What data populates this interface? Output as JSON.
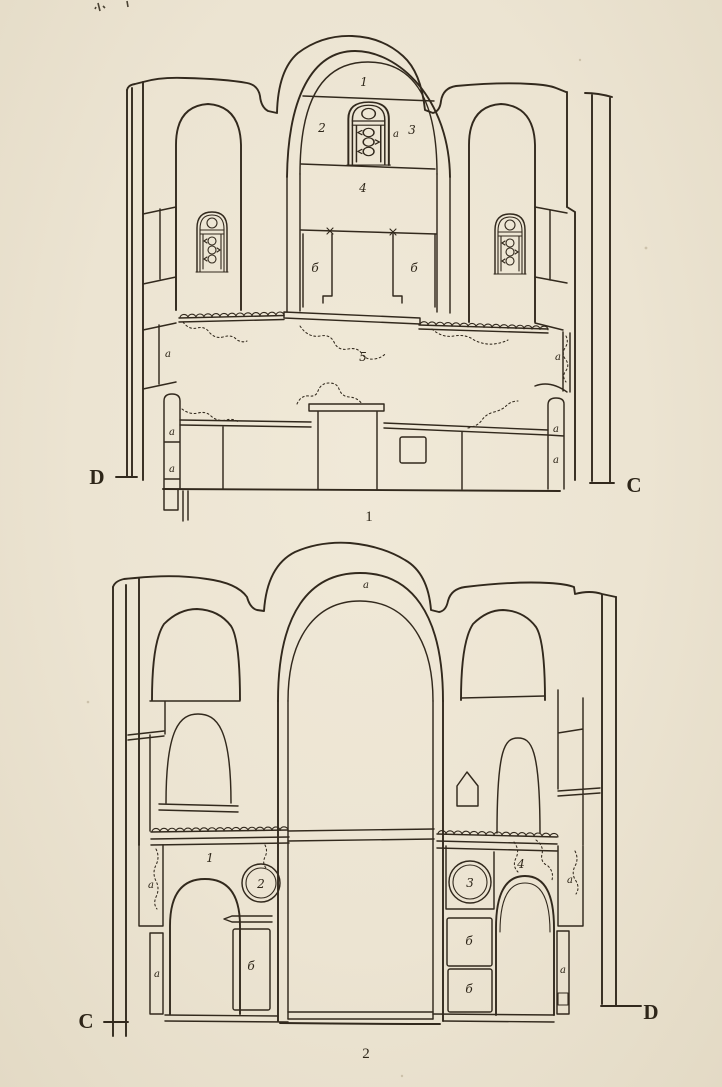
{
  "colors": {
    "paper": "#ece4d2",
    "ink": "#32291d"
  },
  "figure1": {
    "caption": "1",
    "left_letter": "D",
    "right_letter": "C",
    "labels": {
      "lunette": "1",
      "panel_left": "2",
      "panel_right": "3",
      "window_a": "a",
      "panel_below": "4",
      "door_flank_left": "б",
      "door_flank_right": "б",
      "hall": "5",
      "wall_left_a": "a",
      "pilaster_left_a_upper": "a",
      "pilaster_left_a_lower": "a",
      "wall_right_a": "a",
      "pilaster_right_a_upper": "a",
      "pilaster_right_a_lower": "a"
    }
  },
  "figure2": {
    "caption": "2",
    "left_letter": "C",
    "right_letter": "D",
    "labels": {
      "vault_a": "a",
      "gallery_left": "1",
      "medallion_left": "2",
      "medallion_right": "3",
      "gallery_right": "4",
      "door_left": "б",
      "door_right_upper": "б",
      "door_right_lower": "б",
      "pier_left_a": "a",
      "strip_left_a": "a",
      "pier_right_a": "a",
      "strip_right_a": "a"
    }
  }
}
